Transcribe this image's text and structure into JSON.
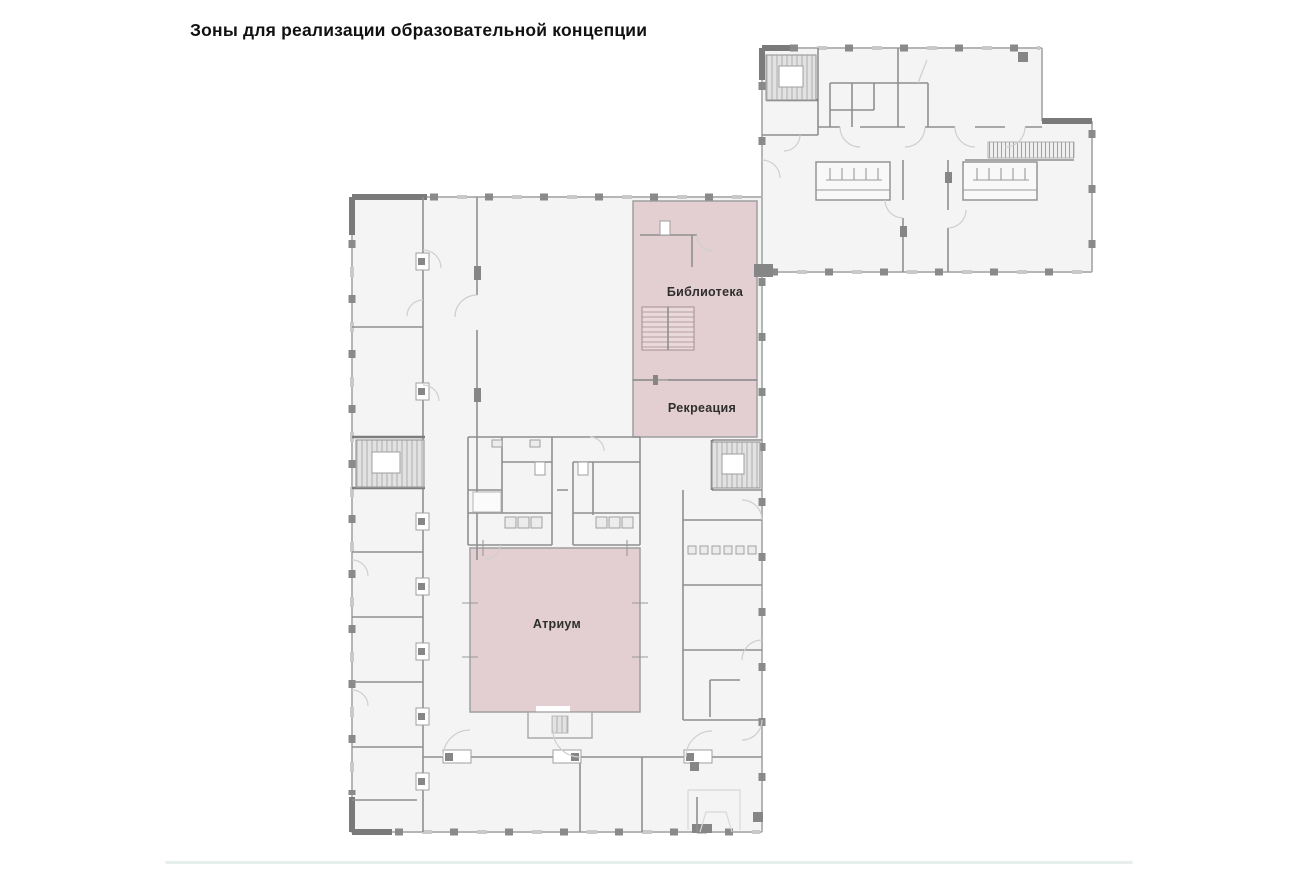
{
  "page": {
    "title": "Зоны для реализации образовательной концепции"
  },
  "zones": [
    {
      "id": "library",
      "label": "Библиотека"
    },
    {
      "id": "recreation",
      "label": "Рекреация"
    },
    {
      "id": "atrium",
      "label": "Атриум"
    }
  ],
  "colors": {
    "zone_fill": "#e3ced1",
    "zone_border": "#9f9f9f",
    "wall": "#8a8a8a",
    "wall_dark": "#7a7a7a",
    "floor": "#f4f4f4",
    "stair_fill": "#e2e2e2",
    "title_text": "#111111",
    "label_text": "#2e2e2e",
    "divider": "#e7efed"
  }
}
